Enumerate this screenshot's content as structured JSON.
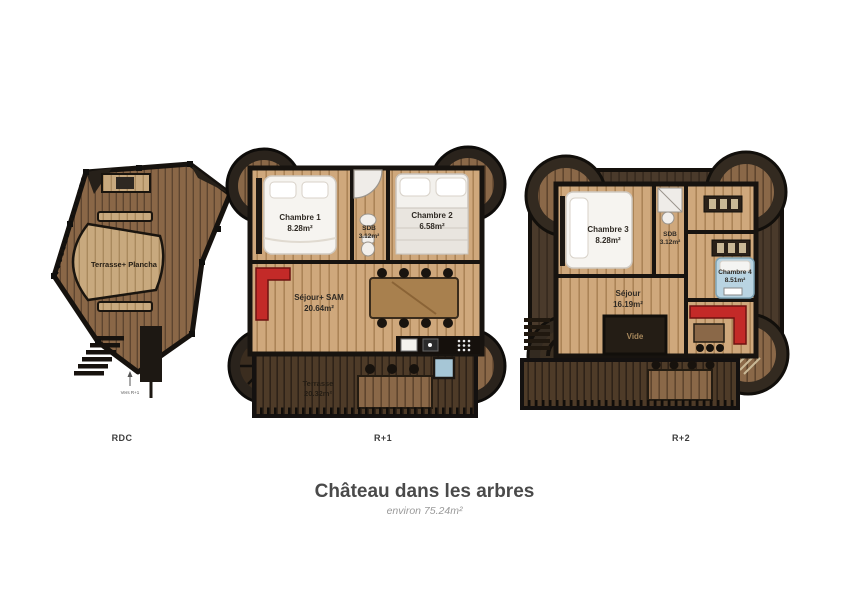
{
  "title": "Château dans les arbres",
  "subtitle": "environ 75.24m²",
  "colors": {
    "background": "#ffffff",
    "wall_dark": "#17130f",
    "wood_light": "#cfa87c",
    "wood_mid": "#8a6848",
    "wood_dark": "#4e3b28",
    "roof_brown": "#4a3a2b",
    "sofa_red": "#c32a28",
    "bed_blue": "#b9d4e2",
    "text_dark": "#4a4a4a",
    "text_muted": "#9a9a9a"
  },
  "floors": [
    {
      "id": "rdc",
      "label": "RDC",
      "note": "Vers R+1",
      "rooms": [
        {
          "name": "Terrasse+ Plancha",
          "area": ""
        }
      ]
    },
    {
      "id": "r1",
      "label": "R+1",
      "rooms": [
        {
          "name": "Chambre 1",
          "area": "8.28m²"
        },
        {
          "name": "SDB",
          "area": "3.12m²"
        },
        {
          "name": "Chambre 2",
          "area": "6.58m²"
        },
        {
          "name": "Séjour+ SAM",
          "area": "20.64m²"
        },
        {
          "name": "Terrasse",
          "area": "20.32m²"
        }
      ]
    },
    {
      "id": "r2",
      "label": "R+2",
      "rooms": [
        {
          "name": "Chambre 3",
          "area": "8.28m²"
        },
        {
          "name": "SDB",
          "area": "3.12m²"
        },
        {
          "name": "Chambre 4",
          "area": "8.51m²"
        },
        {
          "name": "Séjour",
          "area": "16.19m²"
        },
        {
          "name": "Vide",
          "area": ""
        }
      ]
    }
  ]
}
